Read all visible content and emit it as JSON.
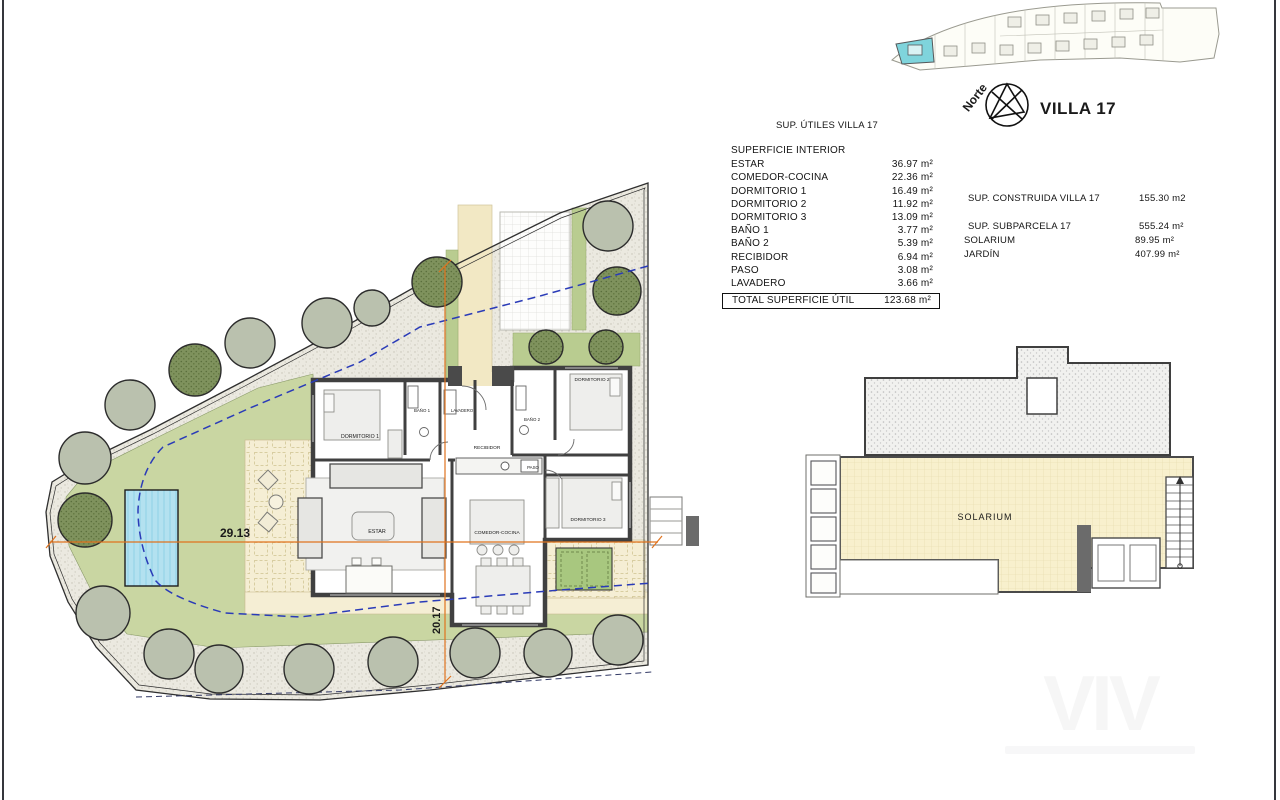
{
  "header": {
    "villa_title": "VILLA 17",
    "north_label": "Norte"
  },
  "areas_table": {
    "title": "SUP. ÚTILES VILLA 17",
    "header": "SUPERFICIE INTERIOR",
    "rows": [
      {
        "label": "ESTAR",
        "value": "36.97 m²"
      },
      {
        "label": "COMEDOR-COCINA",
        "value": "22.36 m²"
      },
      {
        "label": "DORMITORIO 1",
        "value": "16.49 m²"
      },
      {
        "label": "DORMITORIO 2",
        "value": "11.92 m²"
      },
      {
        "label": "DORMITORIO 3",
        "value": "13.09 m²"
      },
      {
        "label": "BAÑO 1",
        "value": "3.77 m²"
      },
      {
        "label": "BAÑO 2",
        "value": "5.39 m²"
      },
      {
        "label": "RECIBIDOR",
        "value": "6.94 m²"
      },
      {
        "label": "PASO",
        "value": "3.08 m²"
      },
      {
        "label": "LAVADERO",
        "value": "3.66 m²"
      }
    ],
    "total": {
      "label": "TOTAL SUPERFICIE ÚTIL",
      "value": "123.68 m²"
    }
  },
  "summary_table": {
    "rows": [
      {
        "label": "SUP. CONSTRUIDA VILLA 17",
        "value": "155.30 m2"
      },
      {
        "label": "SUP. SUBPARCELA 17",
        "value": "555.24 m²"
      },
      {
        "label": "SOLARIUM",
        "value": "89.95 m²"
      },
      {
        "label": "JARDÍN",
        "value": "407.99 m²"
      }
    ]
  },
  "floor_plan": {
    "labels": {
      "dormitorio1": "DORMITORIO 1",
      "dormitorio2": "DORMITORIO 2",
      "dormitorio3": "DORMITORIO 3",
      "bano1": "BAÑO 1",
      "bano2": "BAÑO 2",
      "recibidor": "RECIBIDOR",
      "paso": "PASO",
      "lavadero": "LAVADERO",
      "estar": "ESTAR",
      "comedor": "COMEDOR-COCINA"
    },
    "dimensions": {
      "width": "29.13",
      "height": "20.17"
    }
  },
  "solarium": {
    "label": "SOLARIUM"
  },
  "watermark": {
    "text": "VIV"
  },
  "colors": {
    "dimension_orange": "#e0731e",
    "boundary_blue": "#2a3bb8",
    "pool_blue": "#b3e1f0",
    "garden_green": "#c9d6a2",
    "villa_highlight_cyan": "#7fd4dc",
    "terrace_cream": "#f5eed4",
    "solarium_yellow": "#f8f0cd",
    "wall_gray": "#404040"
  }
}
